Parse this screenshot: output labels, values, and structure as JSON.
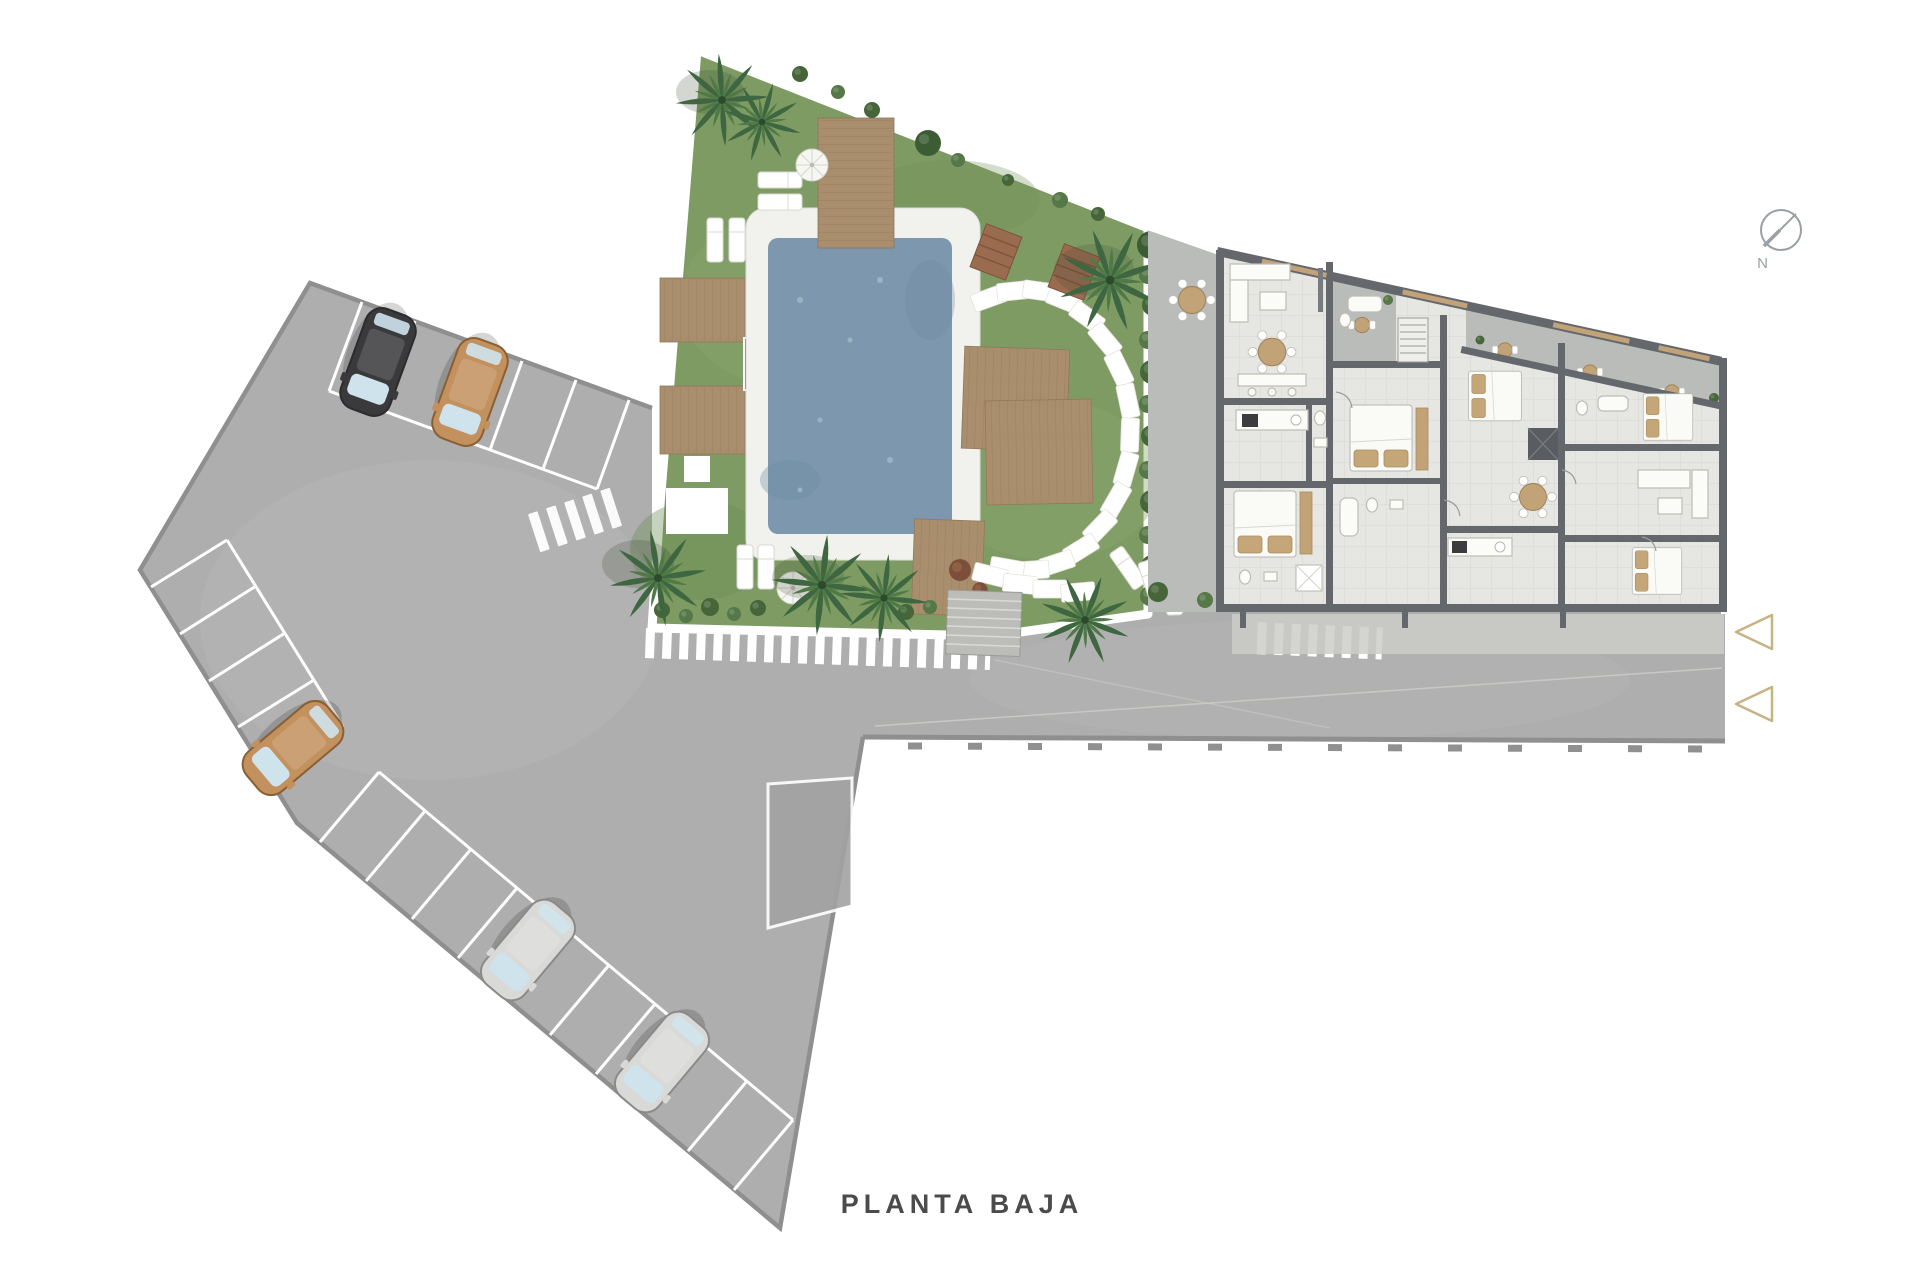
{
  "plan": {
    "title": "PLANTA BAJA",
    "compass_label": "N"
  },
  "colors": {
    "page_bg": "#ffffff",
    "asphalt": "#aeaeae",
    "asphalt_edge": "#8f8f8f",
    "grass": "#7e9b63",
    "grass_light": "#8aa56f",
    "hedge_dark": "#46663a",
    "hedge_mid": "#567747",
    "pool_water": "#7d98ae",
    "pool_deck": "#f1f1ed",
    "wood": "#a88e6c",
    "wood_line": "#8f7458",
    "floor": "#e6e6e3",
    "floor_line": "#d6d6d1",
    "wall": "#64686c",
    "terrace": "#b9bcb8",
    "furniture_white": "#fbfbf8",
    "accent_wood": "#c2a277",
    "pillow": "#c4a678",
    "car_black": "#3a3a3c",
    "car_tan": "#c2915e",
    "car_silver": "#d9dad8",
    "arrow": "#c9b283",
    "compass": "#9aa0a4",
    "text": "#4b4b4b"
  },
  "cars": {
    "count": 5,
    "colors": [
      "black",
      "tan",
      "tan",
      "silver",
      "silver"
    ]
  },
  "entrance_arrows": {
    "count": 2
  }
}
